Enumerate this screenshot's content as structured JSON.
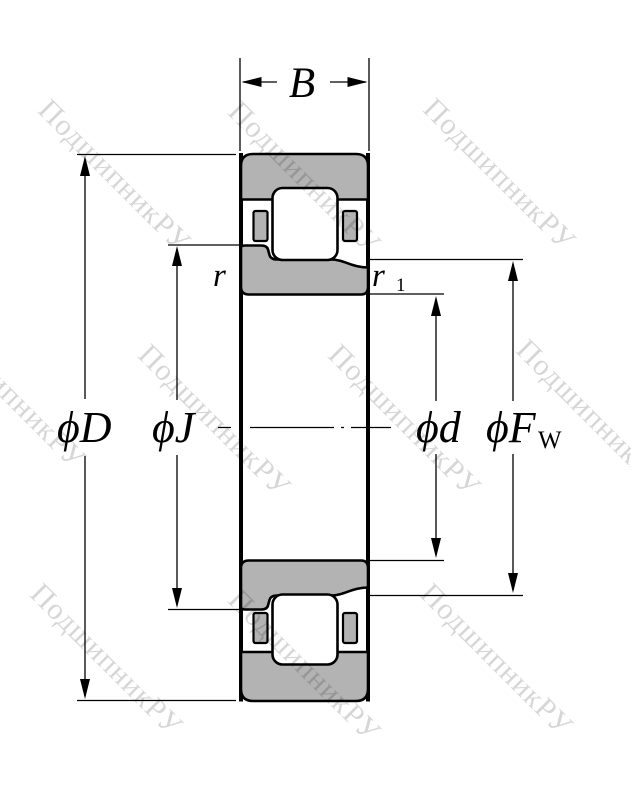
{
  "watermark": {
    "text": "ПодшипникРУ"
  },
  "labels": {
    "width": "B",
    "outer_diameter": "ϕD",
    "rib_diameter": "ϕJ",
    "bore_diameter": "ϕd",
    "raceway_diameter_main": "ϕF",
    "raceway_diameter_sub": "W",
    "chamfer": "r",
    "chamfer_inner_main": "r",
    "chamfer_inner_sub": "1"
  },
  "colors": {
    "background": "#ffffff",
    "line": "#000000",
    "ring-fill": "#b3b3b3",
    "watermark": "rgba(0,0,0,0.16)"
  }
}
